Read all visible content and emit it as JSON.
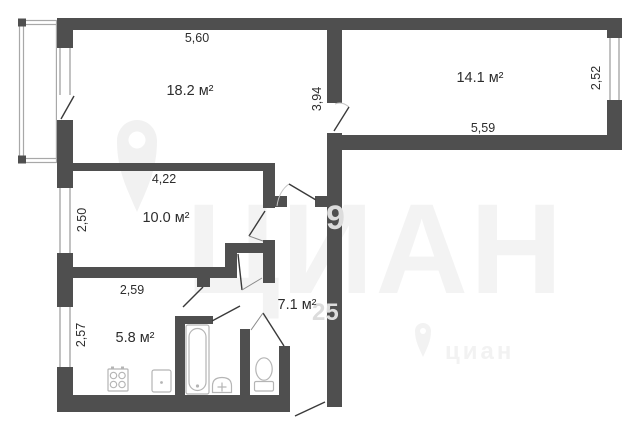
{
  "plan": {
    "rooms": [
      {
        "id": "living-room",
        "area_label": "18.2 м²"
      },
      {
        "id": "bedroom",
        "area_label": "14.1 м²"
      },
      {
        "id": "second-room",
        "area_label": "10.0 м²"
      },
      {
        "id": "kitchen",
        "area_label": "5.8 м²"
      },
      {
        "id": "hallway",
        "area_label": "7.1 м²"
      }
    ],
    "dimensions": [
      {
        "id": "living-top-width",
        "value": "5,60"
      },
      {
        "id": "living-right-height",
        "value": "3,94"
      },
      {
        "id": "bedroom-right-height",
        "value": "2,52"
      },
      {
        "id": "bedroom-bottom-width",
        "value": "5,59"
      },
      {
        "id": "room-top-width",
        "value": "4,22"
      },
      {
        "id": "room-left-height",
        "value": "2,50"
      },
      {
        "id": "kitchen-top-width",
        "value": "2,59"
      },
      {
        "id": "kitchen-left-height",
        "value": "2,57"
      }
    ],
    "fixtures": [
      "stove-icon",
      "kitchen-sink-icon",
      "bathtub-icon",
      "washbasin-icon",
      "toilet-icon"
    ],
    "colors": {
      "wall": "#4f4f4f",
      "fixture_outline": "#b5b5b5",
      "label_text": "#2d2d2d",
      "watermark": "#f3f3f3",
      "background": "#ffffff"
    },
    "watermark": {
      "brand_large": "ЦИАН",
      "brand_small": "циан",
      "fragments": [
        "9",
        "25"
      ]
    }
  }
}
